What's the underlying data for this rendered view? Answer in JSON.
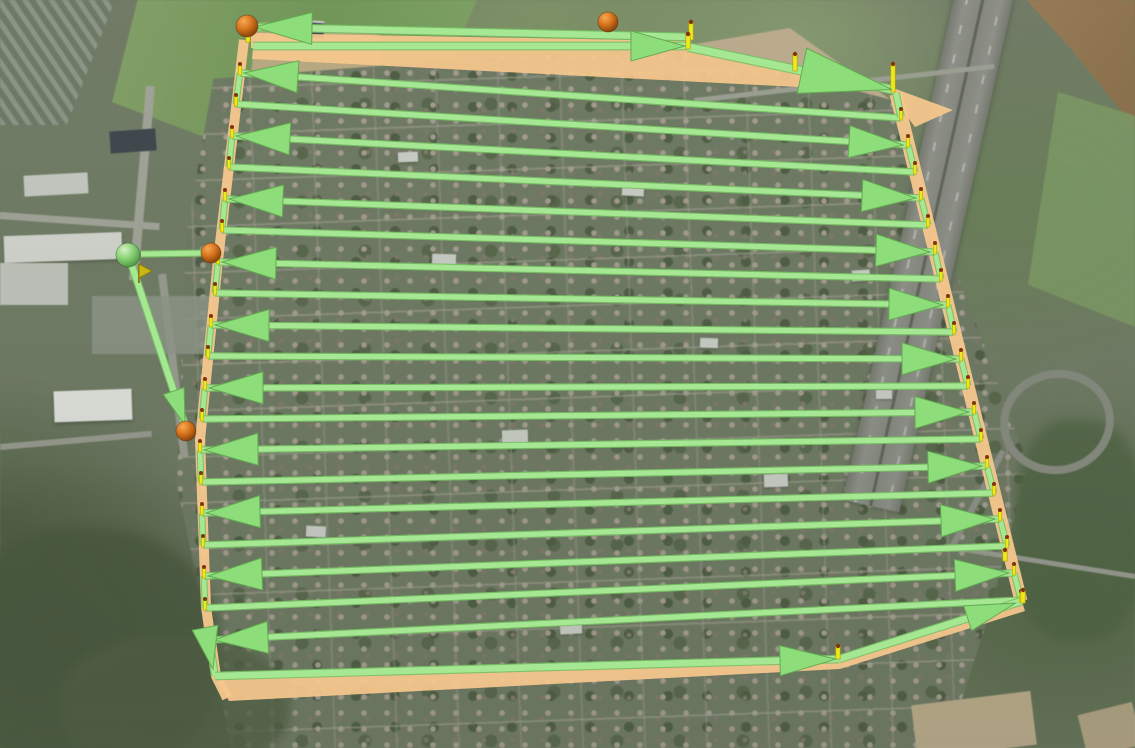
{
  "scene": {
    "type": "aerial-satellite-view-with-drone-survey-route",
    "width": 1135,
    "height": 748
  },
  "palette": {
    "route_light": "#a6e794",
    "route_dark": "#77c063",
    "arrow_fill": "#8edd7b",
    "arrow_dark": "#63ab50",
    "curtain_orange": "#f6c78d",
    "pole_yellow": "#ece91c",
    "pole_dark": "#b5a50a",
    "turn_dot": "#83340f",
    "waypoint_orange": "#d8761f",
    "home_green": "#84cf72",
    "flag_yellow": "#c9b716"
  },
  "flight_path": {
    "rows": [
      {
        "x1": 240,
        "y1": 73,
        "x2": 901,
        "y2": 118,
        "dir": "W"
      },
      {
        "x1": 236,
        "y1": 104,
        "x2": 908,
        "y2": 145,
        "dir": "E"
      },
      {
        "x1": 232,
        "y1": 136,
        "x2": 915,
        "y2": 172,
        "dir": "W"
      },
      {
        "x1": 229,
        "y1": 167,
        "x2": 921,
        "y2": 198,
        "dir": "E"
      },
      {
        "x1": 225,
        "y1": 199,
        "x2": 928,
        "y2": 225,
        "dir": "W"
      },
      {
        "x1": 222,
        "y1": 230,
        "x2": 935,
        "y2": 252,
        "dir": "E"
      },
      {
        "x1": 218,
        "y1": 262,
        "x2": 941,
        "y2": 279,
        "dir": "W"
      },
      {
        "x1": 215,
        "y1": 293,
        "x2": 948,
        "y2": 305,
        "dir": "E"
      },
      {
        "x1": 211,
        "y1": 325,
        "x2": 954,
        "y2": 332,
        "dir": "W"
      },
      {
        "x1": 208,
        "y1": 356,
        "x2": 961,
        "y2": 359,
        "dir": "E"
      },
      {
        "x1": 205,
        "y1": 388,
        "x2": 968,
        "y2": 386,
        "dir": "W"
      },
      {
        "x1": 202,
        "y1": 419,
        "x2": 974,
        "y2": 412,
        "dir": "E"
      },
      {
        "x1": 200,
        "y1": 450,
        "x2": 981,
        "y2": 439,
        "dir": "W"
      },
      {
        "x1": 201,
        "y1": 482,
        "x2": 987,
        "y2": 466,
        "dir": "E"
      },
      {
        "x1": 202,
        "y1": 513,
        "x2": 994,
        "y2": 493,
        "dir": "W"
      },
      {
        "x1": 203,
        "y1": 545,
        "x2": 1000,
        "y2": 519,
        "dir": "E"
      },
      {
        "x1": 204,
        "y1": 576,
        "x2": 1007,
        "y2": 546,
        "dir": "W"
      },
      {
        "x1": 205,
        "y1": 608,
        "x2": 1014,
        "y2": 573,
        "dir": "E"
      },
      {
        "x1": 210,
        "y1": 640,
        "x2": 1021,
        "y2": 600,
        "dir": "W"
      }
    ],
    "legs": [
      {
        "name": "top-pass-west",
        "x1": 691,
        "y1": 37,
        "x2": 252,
        "y2": 27,
        "w": 6.5,
        "arrow": true,
        "alen": 58,
        "awid": 32,
        "set": 2
      },
      {
        "name": "top-pass-east",
        "x1": 253,
        "y1": 46,
        "x2": 687,
        "y2": 46,
        "w": 6.5,
        "arrow": true,
        "alen": 54,
        "awid": 30,
        "set": 2
      },
      {
        "name": "top-diagonal",
        "x1": 688,
        "y1": 47,
        "x2": 894,
        "y2": 90,
        "w": 7.5,
        "arrow": true,
        "alen": 92,
        "awid": 46,
        "set": 2
      },
      {
        "name": "right-edge-entry",
        "x1": 896,
        "y1": 93,
        "x2": 901,
        "y2": 117,
        "w": 5.5,
        "arrow": false
      },
      {
        "name": "left-edge-bottom",
        "x1": 210,
        "y1": 641,
        "x2": 215,
        "y2": 676,
        "w": 5.5,
        "arrow": false
      },
      {
        "name": "bottom-pass",
        "x1": 215,
        "y1": 676,
        "x2": 839,
        "y2": 659,
        "w": 6.5,
        "arrow": true,
        "alen": 56,
        "awid": 30,
        "set": 3
      },
      {
        "name": "bottom-diagonal",
        "x1": 839,
        "y1": 659,
        "x2": 1022,
        "y2": 601,
        "w": 6.5,
        "arrow": true,
        "alen": 50,
        "awid": 26,
        "set": 7
      },
      {
        "name": "home-connector",
        "x1": 141,
        "y1": 254,
        "x2": 207,
        "y2": 253,
        "w": 5,
        "arrow": false
      },
      {
        "name": "entry-descent",
        "x1": 131,
        "y1": 263,
        "x2": 186,
        "y2": 428,
        "w": 6,
        "arrow": true,
        "alen": 36,
        "awid": 22,
        "set": 3
      }
    ],
    "extra_arrows": [
      {
        "name": "turn-down-arrow",
        "tip": [
          213,
          669
        ],
        "from": [
          207,
          638
        ],
        "len": 42,
        "wid": 26
      }
    ],
    "left_edge": [
      [
        244,
        40
      ],
      [
        218,
        260
      ],
      [
        200,
        440
      ],
      [
        206,
        607
      ],
      [
        216,
        676
      ],
      [
        227,
        698
      ]
    ],
    "right_edge": [
      [
        896,
        94
      ],
      [
        1021,
        601
      ]
    ],
    "curtains": [
      {
        "name": "top-curtain-strip",
        "points": [
          [
            251,
            33
          ],
          [
            691,
            41
          ],
          [
            691,
            50
          ],
          [
            251,
            48
          ]
        ]
      },
      {
        "name": "top-curtain-wedge",
        "points": [
          [
            253,
            48
          ],
          [
            689,
            50
          ],
          [
            895,
            92
          ],
          [
            252,
            59
          ]
        ]
      },
      {
        "name": "top-right-curtain",
        "points": [
          [
            893,
            88
          ],
          [
            953,
            110
          ],
          [
            915,
            127
          ],
          [
            894,
            99
          ]
        ]
      },
      {
        "name": "bottom-curtain-wedge",
        "points": [
          [
            214,
            673
          ],
          [
            838,
            656
          ],
          [
            1021,
            599
          ],
          [
            1025,
            611
          ],
          [
            840,
            669
          ],
          [
            229,
            701
          ]
        ]
      }
    ],
    "poles": [
      {
        "x": 691,
        "y": 22,
        "h": 18
      },
      {
        "x": 688,
        "y": 34,
        "h": 15
      },
      {
        "x": 795,
        "y": 54,
        "h": 17
      },
      {
        "x": 893,
        "y": 64,
        "h": 28
      },
      {
        "x": 248,
        "y": 28,
        "h": 14
      },
      {
        "x": 838,
        "y": 646,
        "h": 13
      },
      {
        "x": 1023,
        "y": 590,
        "h": 13
      },
      {
        "x": 1005,
        "y": 550,
        "h": 11
      }
    ],
    "markers": {
      "waypoint_spheres": [
        {
          "name": "waypoint-sphere-1",
          "x": 247,
          "y": 26,
          "r": 11
        },
        {
          "name": "waypoint-sphere-2",
          "x": 608,
          "y": 22,
          "r": 10
        },
        {
          "name": "waypoint-sphere-3",
          "x": 211,
          "y": 253,
          "r": 10
        },
        {
          "name": "waypoint-sphere-4",
          "x": 186,
          "y": 431,
          "r": 10
        }
      ],
      "home_sphere": {
        "name": "home-sphere",
        "x": 128,
        "y": 255,
        "r": 12
      },
      "start_flag": {
        "name": "start-flag",
        "x": 139,
        "y": 264,
        "w": 13,
        "h": 14
      }
    }
  }
}
